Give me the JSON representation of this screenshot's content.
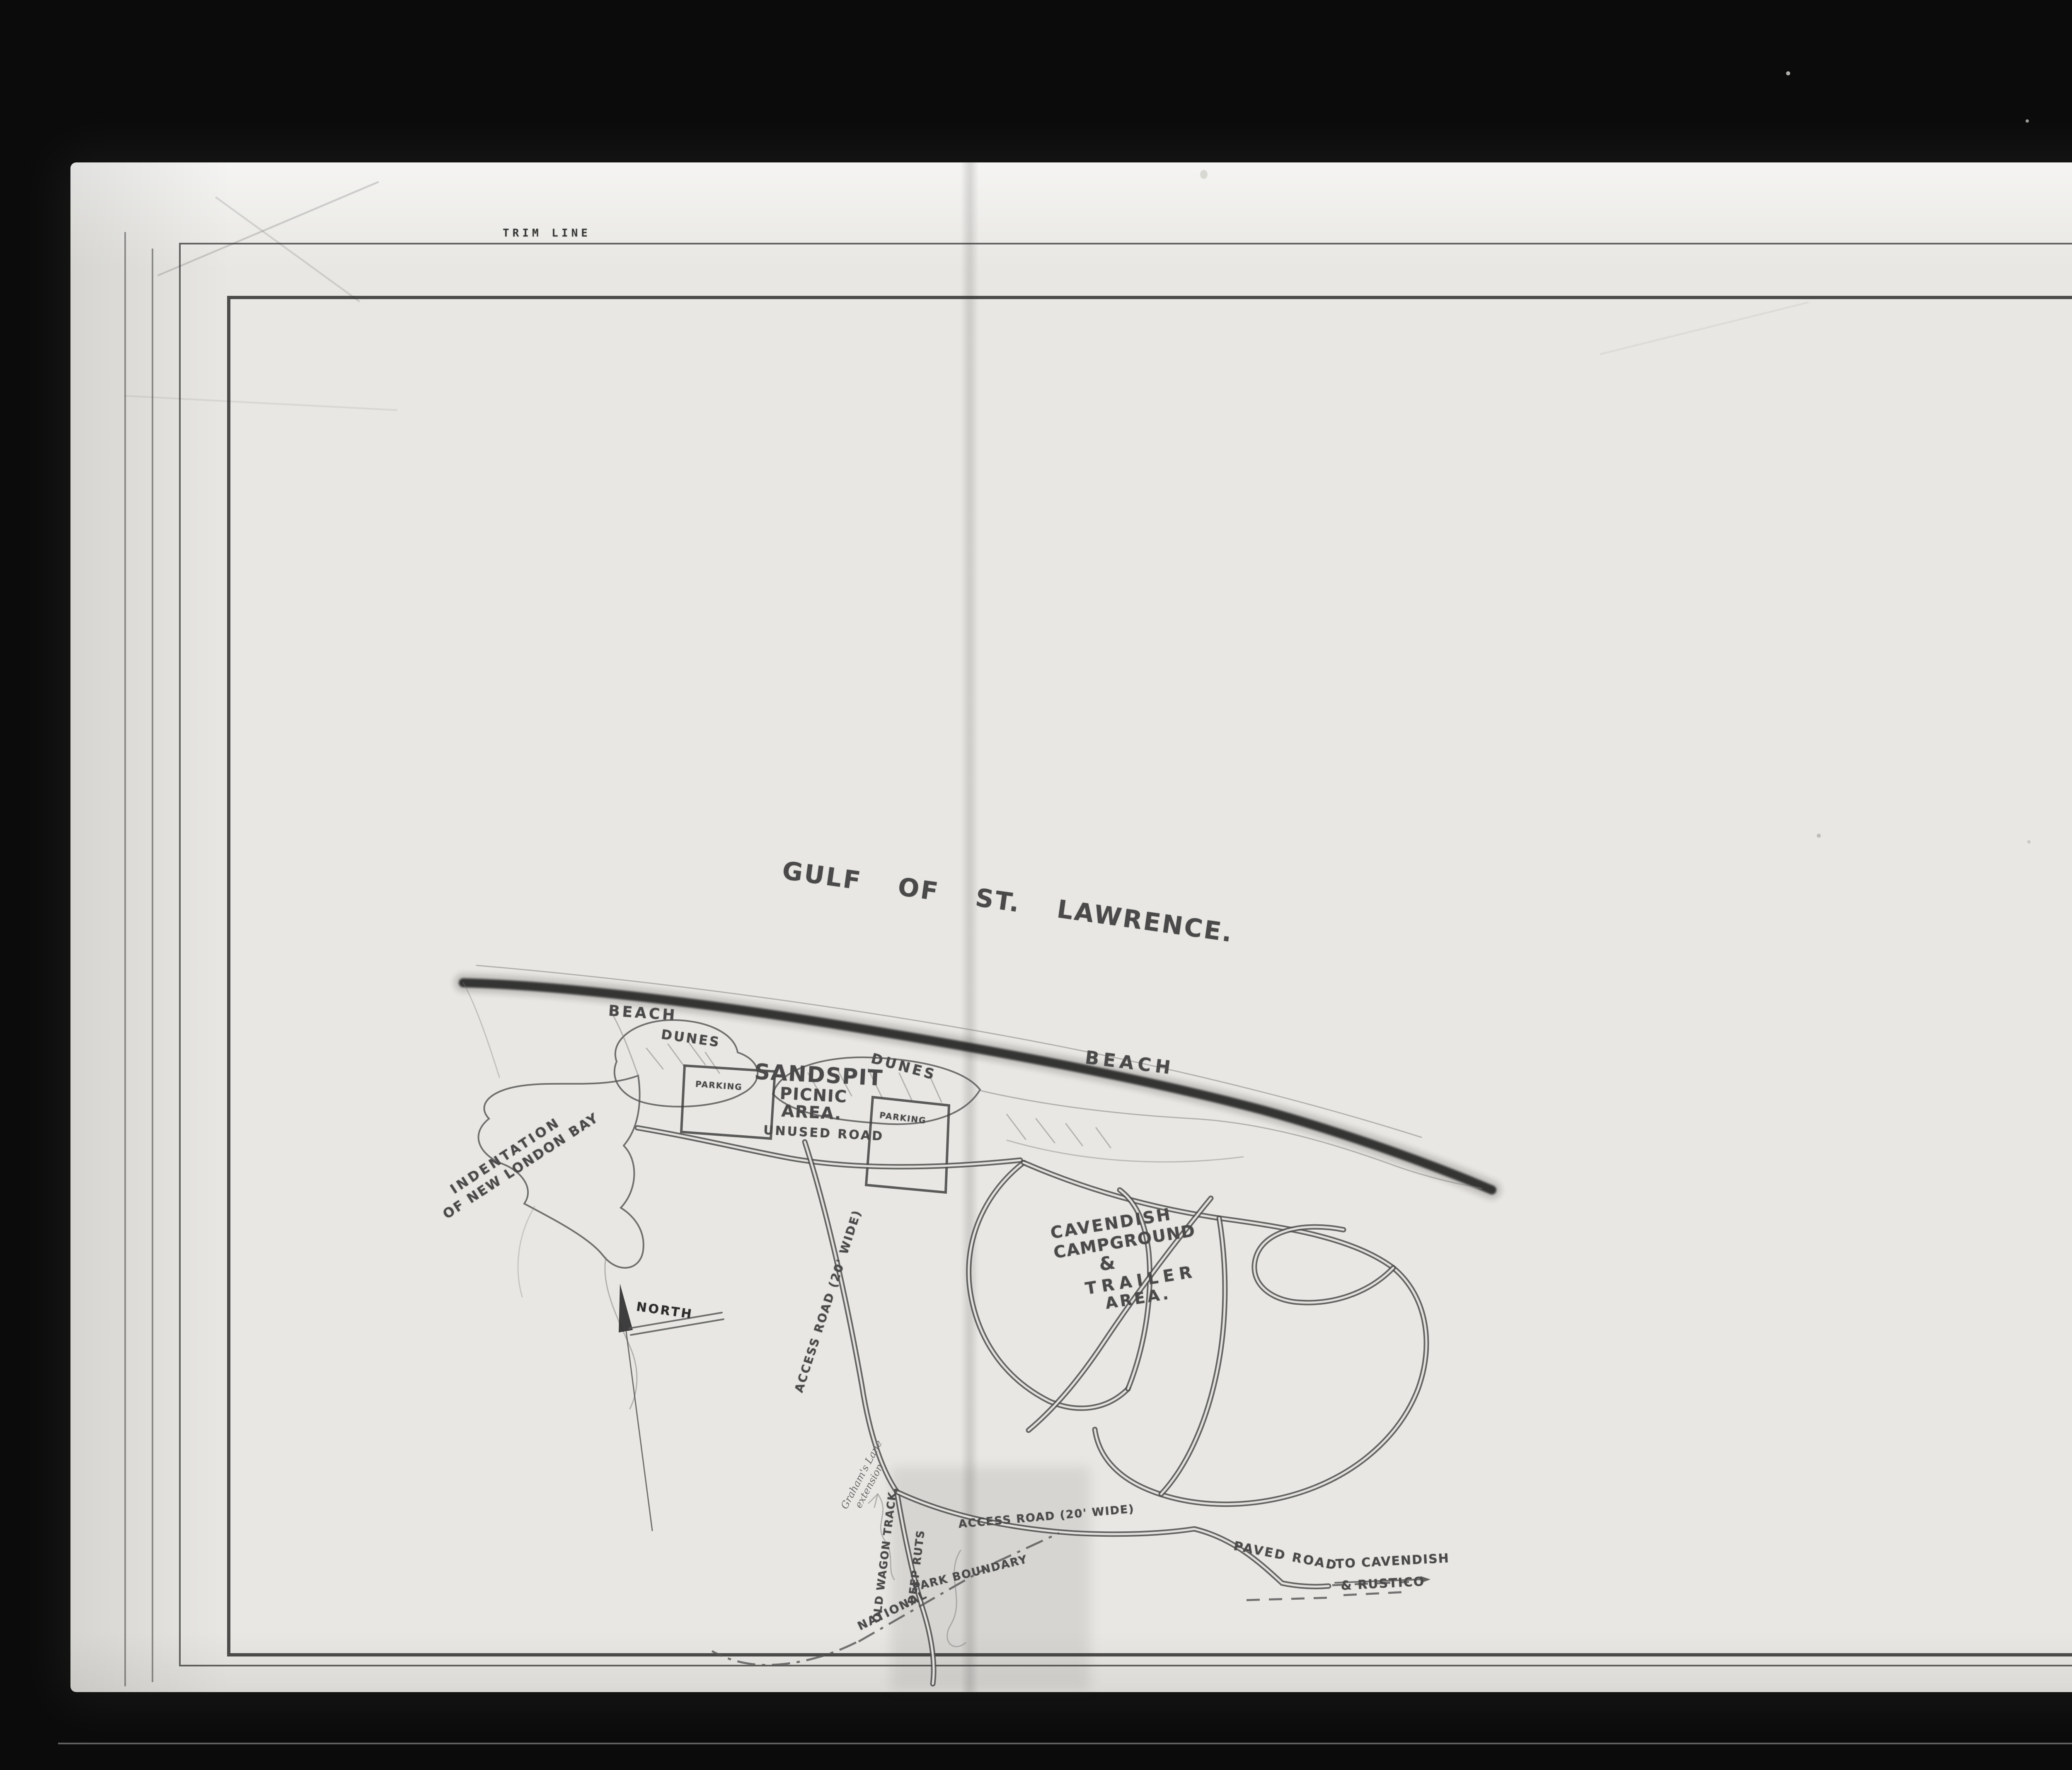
{
  "colors": {
    "film_black": "#0b0b0b",
    "paper": "#e8e7e3",
    "pencil": "#4a4a4a",
    "label_white": "#f4f3ee"
  },
  "film": {
    "frame_number": "000036"
  },
  "sheet": {
    "trim_line_top": "TRIM LINE",
    "trim_line_right": "TRIM LINE"
  },
  "map": {
    "title": "GULF OF ST. LAWRENCE.",
    "beach_left": "BEACH",
    "beach_right": "BEACH",
    "dunes_left": "DUNES",
    "dunes_right": "DUNES",
    "sandspit_lines": [
      "SANDSPIT",
      "PICNIC",
      "AREA."
    ],
    "parking_left": "PARKING",
    "parking_right": "PARKING",
    "unused_road": "UNUSED ROAD",
    "indentation_lines": [
      "INDENTATION",
      "OF NEW LONDON BAY"
    ],
    "north": "NORTH",
    "access_road_gravel": "ACCESS ROAD (20' WIDE)",
    "access_road_south": "ACCESS ROAD (20' WIDE)",
    "campground_lines": [
      "CAVENDISH",
      "CAMPGROUND",
      "&",
      "TRAILER",
      "AREA."
    ],
    "grahams_lane_lines": [
      "Graham's Lane",
      "extension"
    ],
    "old_wagon_track": "OLD WAGON TRACK.",
    "deep_ruts": "DEEP RUTS",
    "boundary_word1": "NATIONAL",
    "boundary_word2": "PARK BOUNDARY",
    "paved_road": "PAVED ROAD",
    "to_cavendish_lines": [
      "TO CAVENDISH",
      "& RUSTICO"
    ]
  },
  "archival": {
    "reference_lines": [
      "RG 84, A-2-a, vol. 1798",
      "File/dossier PEI60 Plans (5)"
    ],
    "agency_lines": [
      "Parks Canada",
      "Parcs Canada"
    ],
    "archives_lines": [
      "National Archives of Canada",
      "Archives nationales du Canada"
    ],
    "page_label": "1 of/de"
  }
}
